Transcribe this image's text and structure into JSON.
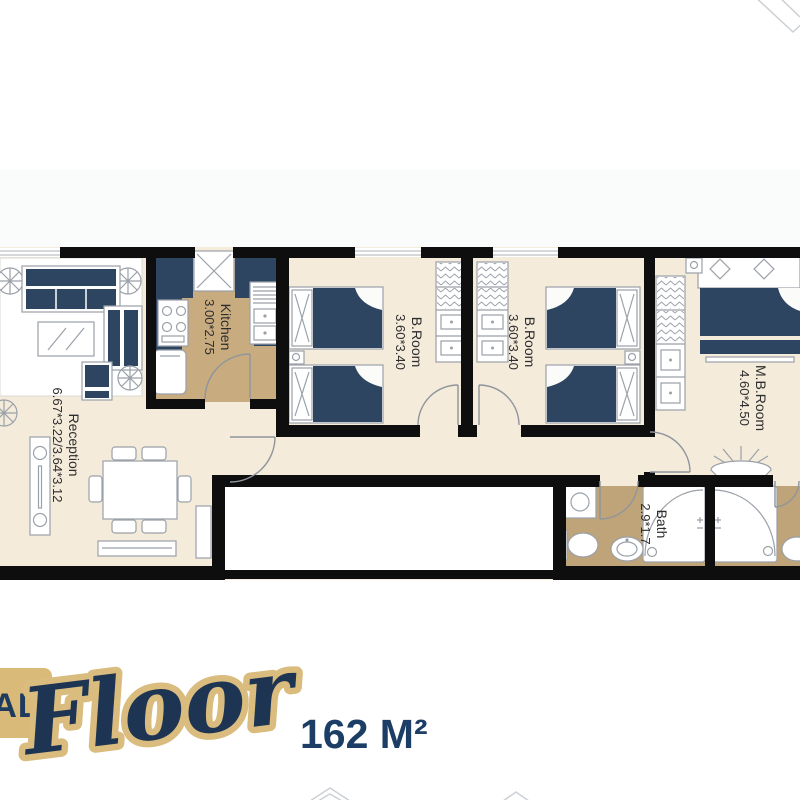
{
  "branding": {
    "banner_text": "AL",
    "script_text": "Floor",
    "area_text": "162 M²"
  },
  "plan": {
    "rooms": [
      {
        "id": "reception",
        "name": "Reception",
        "dims": "6.67*3.22/3.64*3.12"
      },
      {
        "id": "kitchen",
        "name": "Kitchen",
        "dims": "3.00*2.75"
      },
      {
        "id": "broom1",
        "name": "B.Room",
        "dims": "3.60*3.40"
      },
      {
        "id": "broom2",
        "name": "B.Room",
        "dims": "3.60*3.40"
      },
      {
        "id": "mbroom",
        "name": "M.B.Room",
        "dims": "4.60*4.50"
      },
      {
        "id": "bath",
        "name": "Bath",
        "dims": "2.9*1.7"
      }
    ]
  },
  "colors": {
    "wall": "#0e0e0e",
    "floor_cream": "#f4ebdb",
    "floor_tan_kitchen": "#c9ab80",
    "floor_tan_bath": "#bfa379",
    "furniture_navy": "#2d4560",
    "outline_gray": "#9aa1a8",
    "gold": "#d9ba79",
    "navy_text": "#1d3a5f",
    "label_text": "#2d2d2d"
  }
}
